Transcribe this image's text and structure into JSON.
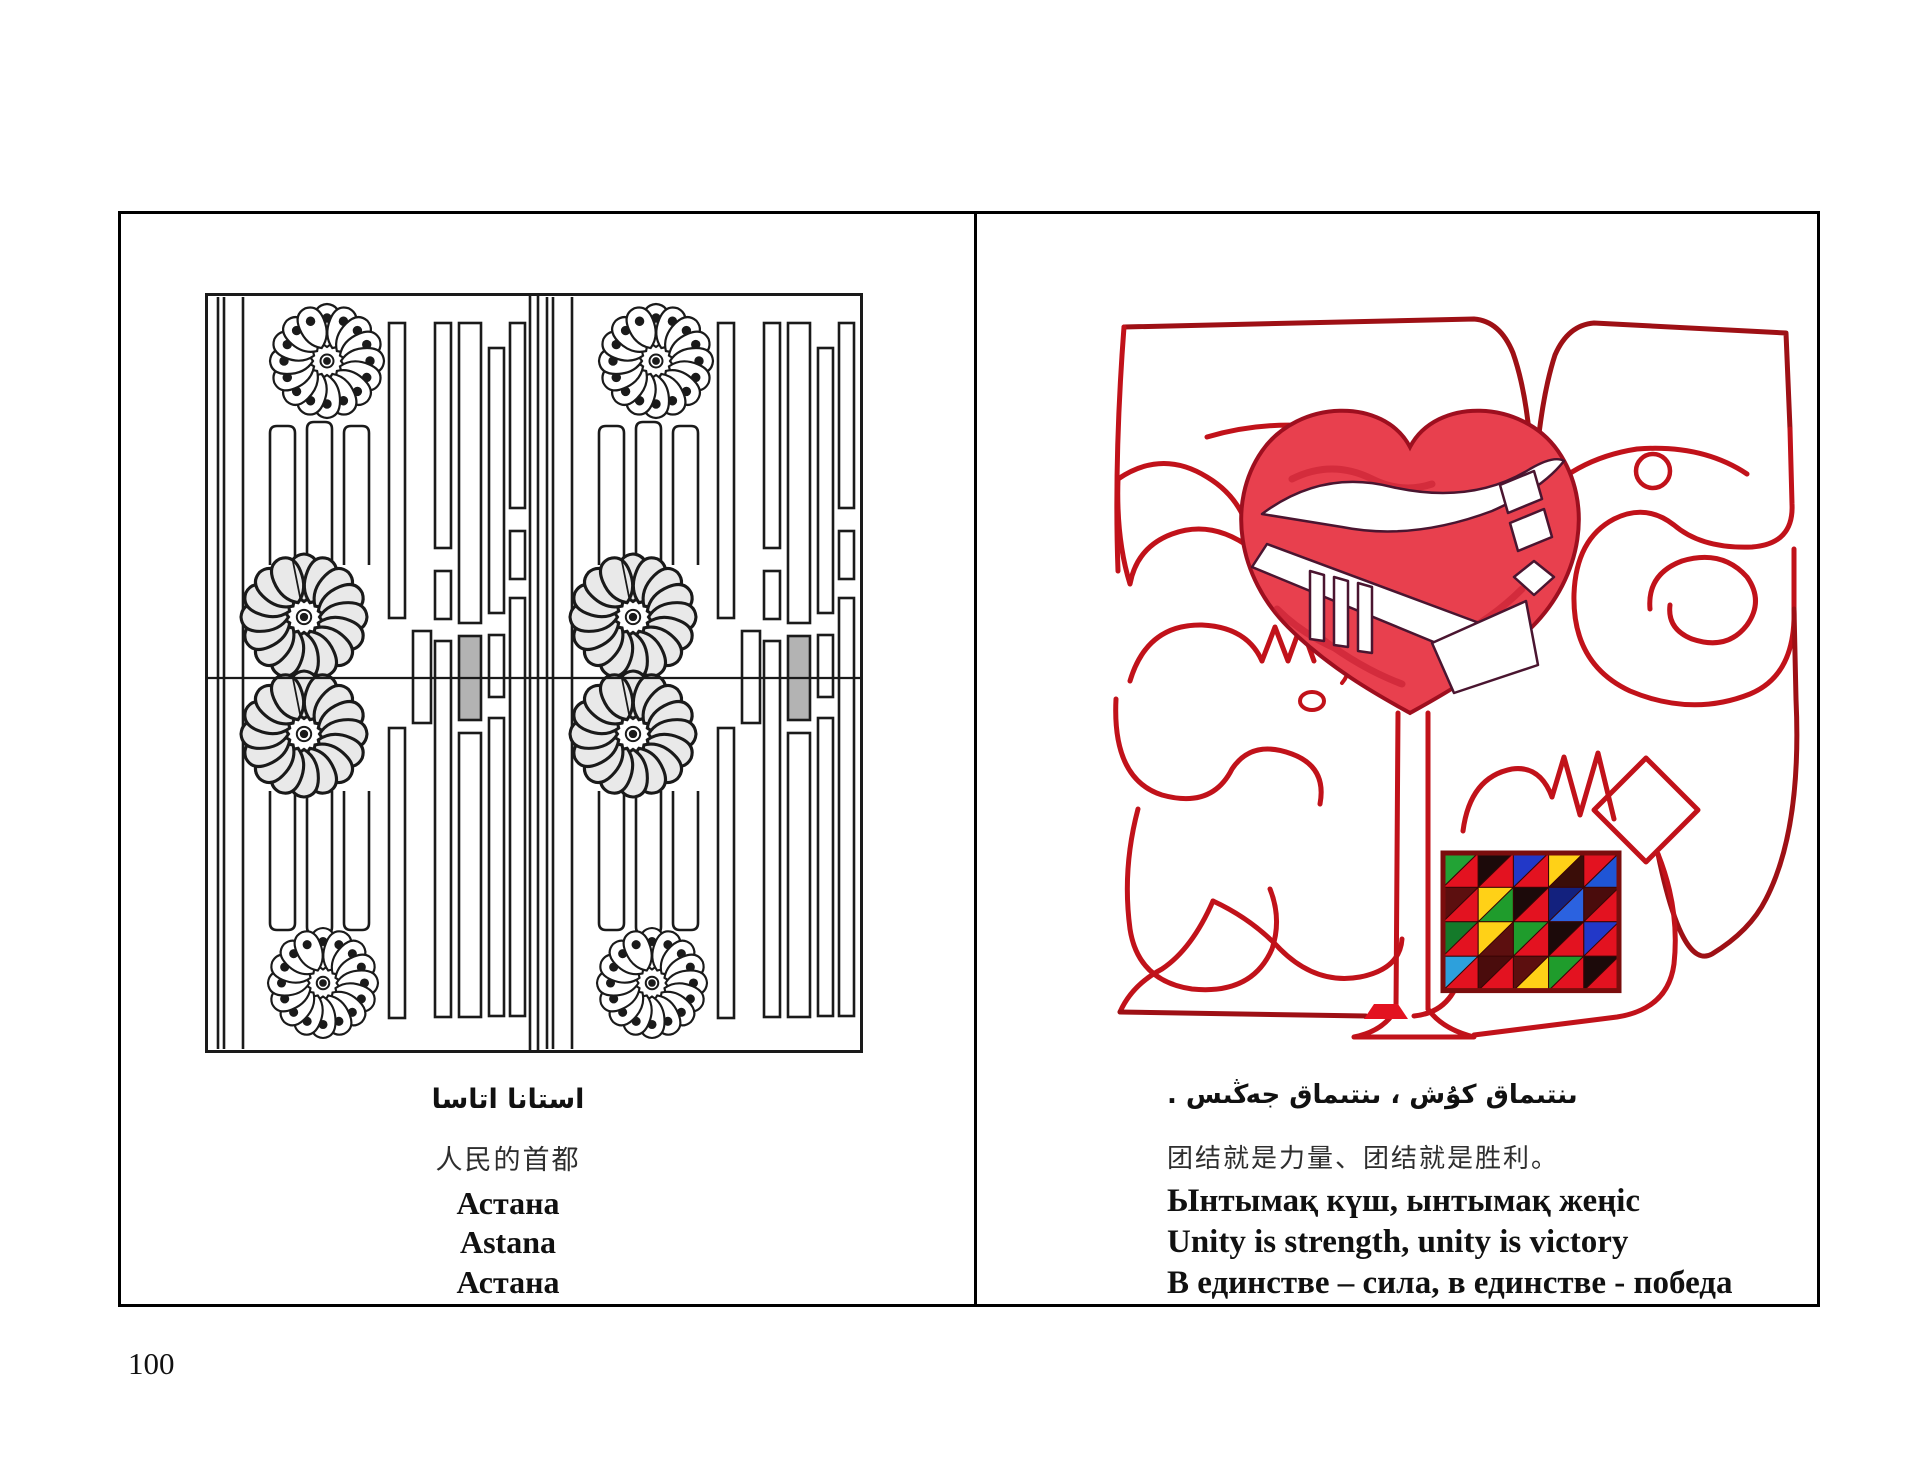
{
  "page": {
    "number": "100",
    "background": "#ffffff",
    "frame_border": "#000000"
  },
  "left_panel": {
    "description": "black and white ornamental lattice drawing with rosette flowers",
    "caption_arabic": "استانا اتاسا",
    "caption_chinese": "人民的首都",
    "caption_kazakh_cyrillic": "Астана",
    "caption_latin": "Astana",
    "caption_russian": "Астана",
    "drawing": {
      "ink": "#1a1a1a",
      "gray_block": "#b3b3b3"
    }
  },
  "right_panel": {
    "description": "red calligraphic artwork with heart and color mosaic",
    "caption_arabic": "ىنتىماق كۇش ، ىنتىماق جەڭىس .",
    "caption_chinese": "团结就是力量、团结就是胜利。",
    "caption_kazakh_cyrillic": "Ынтымақ күш, ынтымақ жеңіс",
    "caption_english": "Unity is strength, unity is victory",
    "caption_russian": "В единстве – сила, в единстве - победа",
    "artwork": {
      "stroke_color": "#c1121a",
      "stroke_dark": "#7a0d0d",
      "heart_fill": "#e8404e",
      "heart_edge": "#9e0f1f",
      "accent_fill": "#e31220",
      "mosaic": {
        "border": "#7a0d0d",
        "rows": [
          [
            [
              "#22a335",
              "#e31220"
            ],
            [
              "#1c0a0a",
              "#e31220"
            ],
            [
              "#2238c8",
              "#e31220"
            ],
            [
              "#ffd117",
              "#3a0d08"
            ],
            [
              "#e31220",
              "#1f55d6"
            ]
          ],
          [
            [
              "#5c0f0f",
              "#e31220"
            ],
            [
              "#ffd117",
              "#1f9c2c"
            ],
            [
              "#1c0a0a",
              "#e31220"
            ],
            [
              "#13217e",
              "#2b62e0"
            ],
            [
              "#4a0c0c",
              "#e31220"
            ]
          ],
          [
            [
              "#147a2a",
              "#e31220"
            ],
            [
              "#ffd117",
              "#5c0f0f"
            ],
            [
              "#1f9c2c",
              "#e31220"
            ],
            [
              "#1c0a0a",
              "#e31220"
            ],
            [
              "#2238c8",
              "#e31220"
            ]
          ],
          [
            [
              "#2da0dc",
              "#e31220"
            ],
            [
              "#4a0c0c",
              "#e31220"
            ],
            [
              "#5c0f0f",
              "#ffd117"
            ],
            [
              "#1f9c2c",
              "#e31220"
            ],
            [
              "#1c0a0a",
              "#e31220"
            ]
          ]
        ]
      }
    }
  }
}
